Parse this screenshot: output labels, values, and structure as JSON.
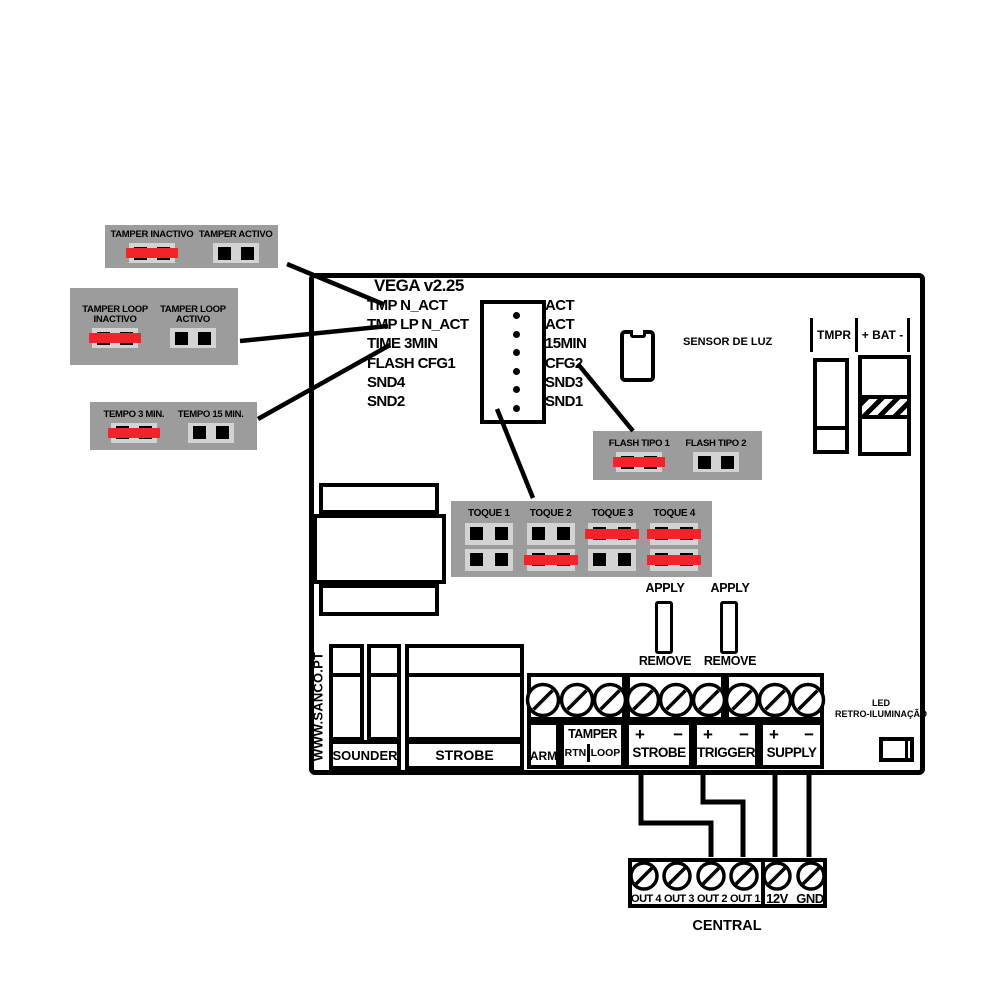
{
  "board": {
    "title": "VEGA v2.25",
    "website": "WWW.SANCO.PT"
  },
  "config_boxes": {
    "tamper": {
      "options": [
        {
          "line1": "TAMPER INACTIVO",
          "state": "closed"
        },
        {
          "line1": "TAMPER ACTIVO",
          "state": "open"
        }
      ]
    },
    "tamper_loop": {
      "options": [
        {
          "line1": "TAMPER LOOP",
          "line2": "INACTIVO",
          "state": "closed"
        },
        {
          "line1": "TAMPER LOOP",
          "line2": "ACTIVO",
          "state": "open"
        }
      ]
    },
    "tempo": {
      "options": [
        {
          "line1": "TEMPO 3 MIN.",
          "state": "closed"
        },
        {
          "line1": "TEMPO 15 MIN.",
          "state": "open"
        }
      ]
    },
    "flash": {
      "options": [
        {
          "line1": "FLASH TIPO 1",
          "state": "closed"
        },
        {
          "line1": "FLASH TIPO 2",
          "state": "open"
        }
      ]
    }
  },
  "pin_header": {
    "left_labels": [
      "TMP N_ACT",
      "TMP LP N_ACT",
      "TIME 3MIN",
      "FLASH CFG1",
      "SND4",
      "SND2"
    ],
    "right_labels": [
      "ACT",
      "ACT",
      "15MIN",
      "CFG2",
      "SND3",
      "SND1"
    ]
  },
  "sensor": {
    "label": "SENSOR DE LUZ"
  },
  "top_terminals": {
    "tmpr": "TMPR",
    "bat": "+ BAT -"
  },
  "toque": {
    "columns": [
      {
        "label": "TOQUE 1",
        "top": "open",
        "bottom": "open"
      },
      {
        "label": "TOQUE 2",
        "top": "open",
        "bottom": "closed"
      },
      {
        "label": "TOQUE 3",
        "top": "closed",
        "bottom": "open"
      },
      {
        "label": "TOQUE 4",
        "top": "closed",
        "bottom": "closed"
      }
    ]
  },
  "apply_remove": {
    "apply": "APPLY",
    "remove": "REMOVE"
  },
  "connectors": {
    "sounder": "SOUNDER",
    "strobe": "STROBE"
  },
  "terminal_labels": {
    "arm": "ARM",
    "tamper": "TAMPER",
    "rtn": "RTN",
    "loop": "LOOP",
    "strobe": "STROBE",
    "trigger": "TRIGGER",
    "supply": "SUPPLY",
    "plus": "+",
    "minus": "−"
  },
  "led": {
    "line1": "LED",
    "line2": "RETRO-ILUMINAÇÃO"
  },
  "central": {
    "labels": [
      "OUT 4",
      "OUT 3",
      "OUT 2",
      "OUT 1",
      "12V",
      "GND"
    ],
    "title": "CENTRAL"
  },
  "colors": {
    "box_gray": "#9c9c9c",
    "pad_gray": "#d3d3d3",
    "jumper_red": "#f2232b",
    "line_black": "#000000"
  }
}
